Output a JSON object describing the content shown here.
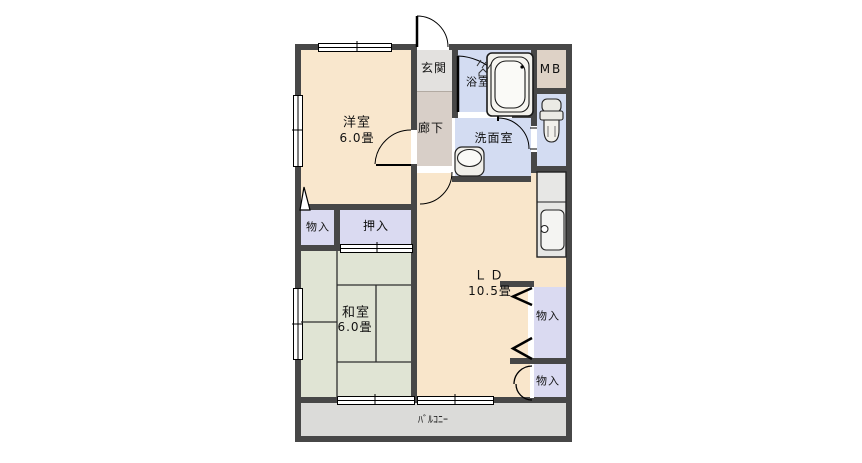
{
  "floorplan": {
    "title": "apartment-floor-plan",
    "rooms": {
      "genkan": {
        "label": "玄関"
      },
      "rouka": {
        "label": "廊下"
      },
      "yoshitsu": {
        "label": "洋室",
        "size": "6.0畳"
      },
      "yokushitsu": {
        "label": "浴室"
      },
      "mb": {
        "label": "MB"
      },
      "senmenshitsu": {
        "label": "洗面室"
      },
      "monoire_left": {
        "label": "物入"
      },
      "oshiire": {
        "label": "押入"
      },
      "washitsu": {
        "label": "和室",
        "size": "6.0畳"
      },
      "ld": {
        "label": "ＬＤ",
        "size": "10.5畳"
      },
      "monoire_right_top": {
        "label": "物入"
      },
      "monoire_right_bottom": {
        "label": "物入"
      },
      "balcony": {
        "label": "ﾊﾞﾙｺﾆｰ"
      }
    },
    "fixtures": [
      "bathtub",
      "toilet",
      "washbasin",
      "kitchen-counter",
      "kitchen-sink",
      "steam-mark"
    ],
    "colors": {
      "wall": "#474747",
      "western_room": "#F9E7CD",
      "living_dining": "#F9E6CB",
      "entrance": "#E3E1DF",
      "corridor": "#D8CFC8",
      "wet_rooms": "#D3DCF2",
      "meter_box": "#DED2C6",
      "storage": "#DADAF1",
      "tatami": "#E0E4D4",
      "balcony": "#DBDBD9",
      "counter": "#E7E7E5"
    }
  }
}
